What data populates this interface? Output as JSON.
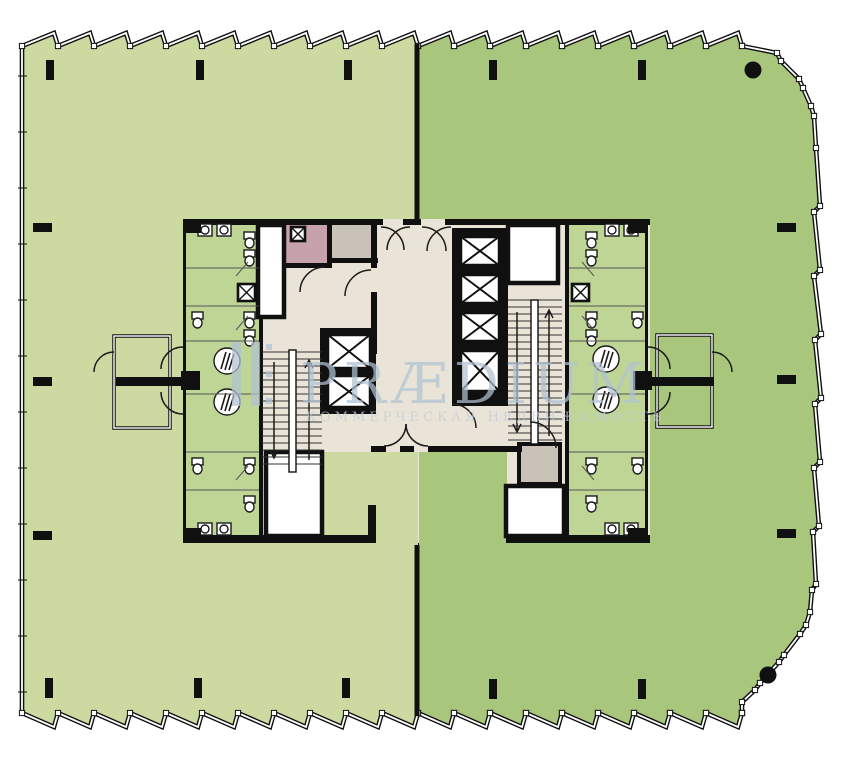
{
  "watermark": {
    "brand": "PRÆDIUM",
    "tagline": "КОММЕРЧЕСКАЯ НЕДВИЖИМОСТЬ"
  },
  "palette": {
    "zone_left": "#ccd9a1",
    "zone_right": "#a9c67d",
    "bath": "#bed595",
    "lobby": "#e9e4d7",
    "room_pink": "#c7a2ab",
    "room_gray": "#c9c2b9",
    "wall": "#101010",
    "watermark_blue": "#b1c3d3",
    "watermark_sub": "#bfcddb"
  },
  "plan": {
    "zone_left_name": "office-zone-left",
    "zone_right_name": "office-zone-right",
    "core_name": "building-core"
  }
}
